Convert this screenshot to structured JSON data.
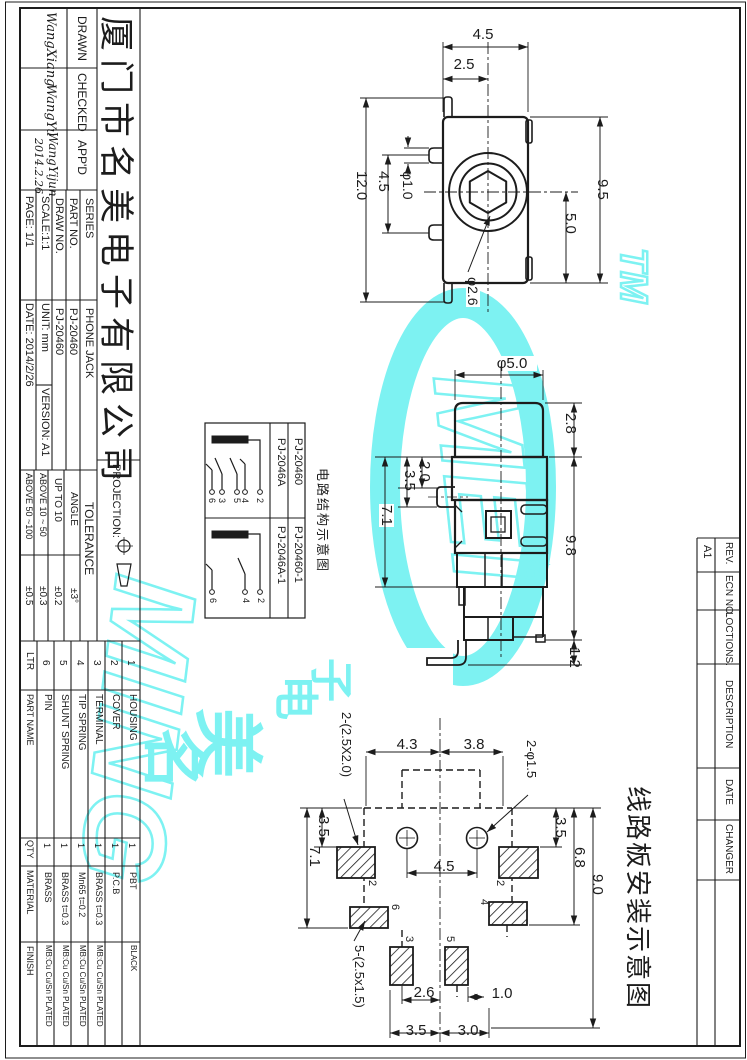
{
  "sheet": {
    "company": "厦门市名美电子有限公司",
    "drawn": {
      "label": "DRAWN",
      "name": "WangXiang"
    },
    "checked": {
      "label": "CHECKED",
      "name": "WangYu"
    },
    "approved": {
      "label": "APP'D",
      "name": "WangYijun",
      "date": "2014.2.26"
    },
    "series": {
      "label": "SERIES",
      "value": "PHONE JACK"
    },
    "part_no": {
      "label": "PART NO.",
      "value": "PJ-20460"
    },
    "draw_no": {
      "label": "DRAW NO.",
      "value": "PJ-20460"
    },
    "scale": "SCALE:1:1",
    "unit": "UNIT: mm",
    "version": "VERSION: A1",
    "page": "PAGE: 1/1",
    "date": "DATE: 2014/2/26",
    "projection_label": "PROJECTION:"
  },
  "tolerance": {
    "title": "TOLERANCE",
    "rows": [
      {
        "range": "ANGLE",
        "value": "±3°"
      },
      {
        "range": "UP TO 10",
        "value": "±0.2"
      },
      {
        "range": "ABOVE 10 ~ 50",
        "value": "±0.3"
      },
      {
        "range": "ABOVE 50 ~100",
        "value": "±0.5"
      }
    ]
  },
  "bom": {
    "headers": {
      "ltr": "LTR",
      "name": "PART NAME",
      "qty": "QTY",
      "material": "MATERIAL",
      "finish": "FINISH"
    },
    "rows": [
      {
        "ltr": "6",
        "name": "PIN",
        "qty": "1",
        "material": "BRASS",
        "finish": "MB:Cu Cu/Sn PLATED"
      },
      {
        "ltr": "5",
        "name": "SHUNT SPRING",
        "qty": "1",
        "material": "BRASS t=0.3",
        "finish": "MB:Cu Cu/Sn PLATED"
      },
      {
        "ltr": "4",
        "name": "TIP SPRING",
        "qty": "1",
        "material": "Mn65 t=0.2",
        "finish": "MB:Cu Cu/Sn PLATED"
      },
      {
        "ltr": "3",
        "name": "TERMINAL",
        "qty": "1",
        "material": "BRASS t=0.3",
        "finish": "MB:Cu Cu/Sn PLATED"
      },
      {
        "ltr": "2",
        "name": "COVER",
        "qty": "1",
        "material": "P.C.B",
        "finish": ""
      },
      {
        "ltr": "1",
        "name": "HOUSING",
        "qty": "1",
        "material": "PBT",
        "finish": "BLACK"
      }
    ]
  },
  "rev_strip": {
    "rev_label": "REV.",
    "rev_value": "A1",
    "ecn_label": "ECN NO.",
    "locations_label": "LOCTIONS.",
    "description_label": "DESCRIPTION",
    "date_label": "DATE",
    "changed_label": "CHANGER"
  },
  "schematic": {
    "caption": "电路结构示意图",
    "models": [
      {
        "code": "PJ-2046A",
        "code2": "PJ-20460",
        "pins": [
          "6",
          "3",
          "5",
          "4",
          "2"
        ]
      },
      {
        "code": "PJ-2046A-1",
        "code2": "PJ-20460-1",
        "pins": [
          "6",
          "4",
          "2"
        ]
      }
    ]
  },
  "pcb_caption": "线路板安装示意图",
  "front_view": {
    "dims": {
      "overall_w": "4.5",
      "half_w": "2.5",
      "overall_h": "12.0",
      "tab_pitch": "4.5",
      "tab_dia": "φ1.0",
      "body_h": "9.5",
      "lower_h": "5.0",
      "hole_dia": "φ2.6"
    }
  },
  "side_view": {
    "dims": {
      "cap_dia": "φ5.0",
      "cap_h": "2.8",
      "pin_top": "2.0",
      "pin_bottom": "3.5",
      "mid_h": "7.1",
      "body_h": "9.8",
      "leg": "1.2"
    }
  },
  "pcb_view": {
    "dims": {
      "left_pitch": "4.3",
      "right_pitch": "3.8",
      "holes": "2-φ1.5",
      "large_pads": "2-(2.5X2.0)",
      "small_pads": "5-(2.5x1.5)",
      "left_top": "3.5",
      "left_h": "7.1",
      "hole_pitch": "4.5",
      "right_top": "3.5",
      "right_mid": "6.8",
      "right_h": "9.0",
      "bot_left": "2.6",
      "bot_right": "1.0",
      "bot_w1": "3.5",
      "bot_w2": "3.0"
    },
    "pad_labels": [
      "2",
      "2",
      "6",
      "4",
      "3",
      "5"
    ]
  },
  "watermark": {
    "tm": "TM",
    "word1": "MING",
    "word2": "MEI",
    "star": "★",
    "cn": [
      "名",
      "美",
      "电",
      "子"
    ],
    "color": "#7DF2F2"
  }
}
